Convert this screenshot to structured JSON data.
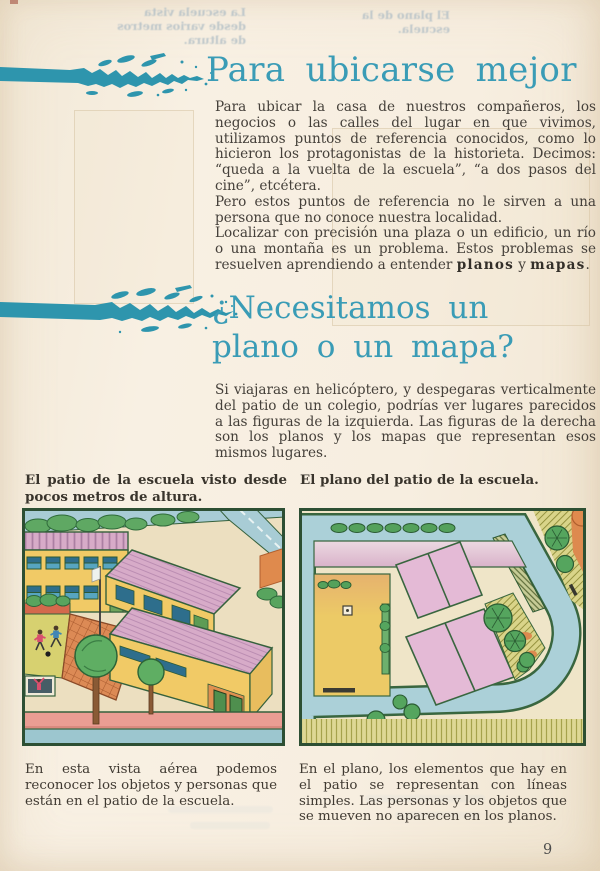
{
  "page": {
    "number": "9"
  },
  "colors": {
    "accent_teal": "#3a9cb6",
    "paper": "#f7eee0",
    "body_text": "#45403a"
  },
  "sections": {
    "intro": {
      "title": "Para ubicarse mejor",
      "paragraphs": {
        "p1": "Para ubicar la casa de nuestros compañeros, los negocios o las calles del lugar en que vivimos, utilizamos puntos de referencia conocidos, como lo hicieron los protagonistas de la historieta. Decimos: “queda a la vuelta de la escuela”, “a dos pasos del cine”, etcétera.",
        "p2": "Pero estos puntos de referencia no le sirven a una persona que no conoce nuestra localidad.",
        "p3_pre": "Localizar con precisión una plaza o un edificio, un río o una montaña es un problema. Estos problemas se resuelven aprendiendo a entender ",
        "p3_bold1": "planos",
        "p3_conj": " y ",
        "p3_bold2": "mapas",
        "p3_end": "."
      }
    },
    "question": {
      "title_line1": "¿Necesitamos un",
      "title_line2": "plano o un mapa?",
      "paragraph": "Si viajaras en helicóptero, y despegaras verticalmente del patio de un colegio, podrías ver lugares parecidos a las figuras de la izquierda. Las figuras de la derecha son los planos y los mapas que representan esos mismos lugares."
    }
  },
  "figures": {
    "aerial": {
      "caption_top": "El patio de la escuela visto desde pocos metros de altura.",
      "caption_bottom": "En esta vista aérea podemos reconocer los objetos y personas que están en el patio de la escuela."
    },
    "plan": {
      "caption_top": "El plano del patio de la escuela.",
      "caption_bottom": "En el plano, los elementos que hay en el patio se representan con líneas simples. Las personas y los objetos que se mueven no aparecen en los planos."
    }
  },
  "bleedthrough": {
    "left": "La escuela vista desde varios metros de altura.",
    "right": "El plano de la escuela."
  }
}
